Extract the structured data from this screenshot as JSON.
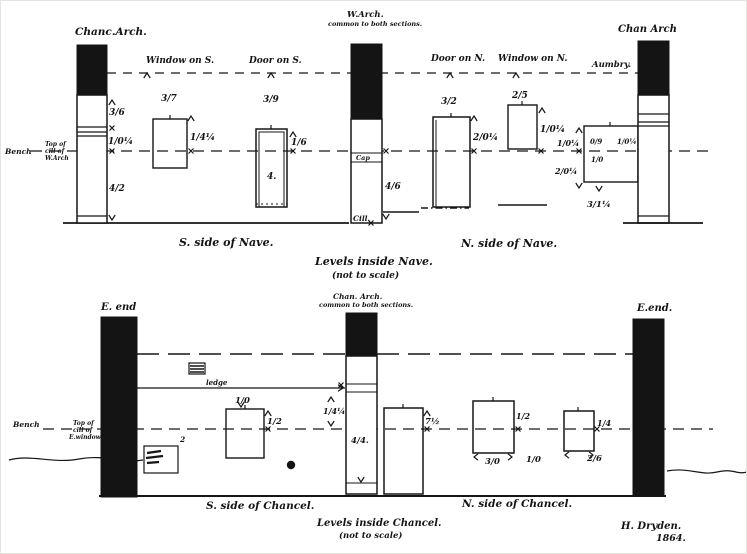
{
  "nave": {
    "captions": {
      "s_side": "S. side of Nave.",
      "levels_line1": "Levels inside Nave.",
      "levels_line2": "(not to scale)",
      "n_side": "N. side of Nave."
    },
    "columns": {
      "chancel_arch": "Chanc.Arch.",
      "west_arch_line1": "W.Arch.",
      "west_arch_line2": "common to both sections.",
      "chan_arch_right": "Chan Arch"
    },
    "openings": {
      "window_s": "Window on S.",
      "door_s": "Door on S.",
      "door_n": "Door on N.",
      "window_n": "Window on N.",
      "aumbry": "Aumbry."
    },
    "datum": {
      "bench": "Bench",
      "note_line1": "Top of",
      "note_line2": "cill of",
      "note_line3": "W.Arch"
    },
    "inner_labels": {
      "cap": "Cap",
      "cill": "Cill."
    },
    "measurements": {
      "chanc_arch_top": "3/6",
      "chanc_arch_mid": "1/0¼",
      "chanc_arch_low": "4/2",
      "window_s_width": "3/7",
      "window_s_height": "1/4¼",
      "door_s_width": "3/9",
      "door_s_height": "1/6",
      "door_s_depth": "4.",
      "w_arch_low": "4/6",
      "door_n_width": "3/2",
      "door_n_height": "2/0¼",
      "window_n_width": "2/5",
      "window_n_height": "1/0¼",
      "aumbry_top": "1/0¼",
      "aumbry_bottom": "2/0¼",
      "aumbry_inner_a": "0/9",
      "aumbry_inner_b": "1/0",
      "aumbry_right": "1/0¼",
      "aumbry_below": "3/1¼"
    }
  },
  "chancel": {
    "captions": {
      "s_side": "S. side of Chancel.",
      "levels_line1": "Levels inside Chancel.",
      "levels_line2": "(not to scale)",
      "n_side": "N. side of Chancel."
    },
    "columns": {
      "e_end_left": "E. end",
      "chan_arch_line1": "Chan. Arch.",
      "chan_arch_line2": "common to both sections.",
      "e_end_right": "E.end."
    },
    "labels": {
      "ledge": "ledge"
    },
    "datum": {
      "bench": "Bench",
      "note_line1": "Top of",
      "note_line2": "cill of",
      "note_line3": "E.window"
    },
    "measurements": {
      "window_s_width": "1/0",
      "window_s_height": "1/2",
      "recess_depth": "2",
      "arch_left": "1/4¼",
      "arch_inner": "4/4.",
      "door_height": "7½",
      "window_n1_height": "1/2",
      "window_n1_width": "3/0",
      "between": "1/0",
      "window_n2_height": "1/4",
      "window_n2_width": "2/6"
    }
  },
  "signature": {
    "name": "H. Dryden.",
    "year": "1864."
  }
}
